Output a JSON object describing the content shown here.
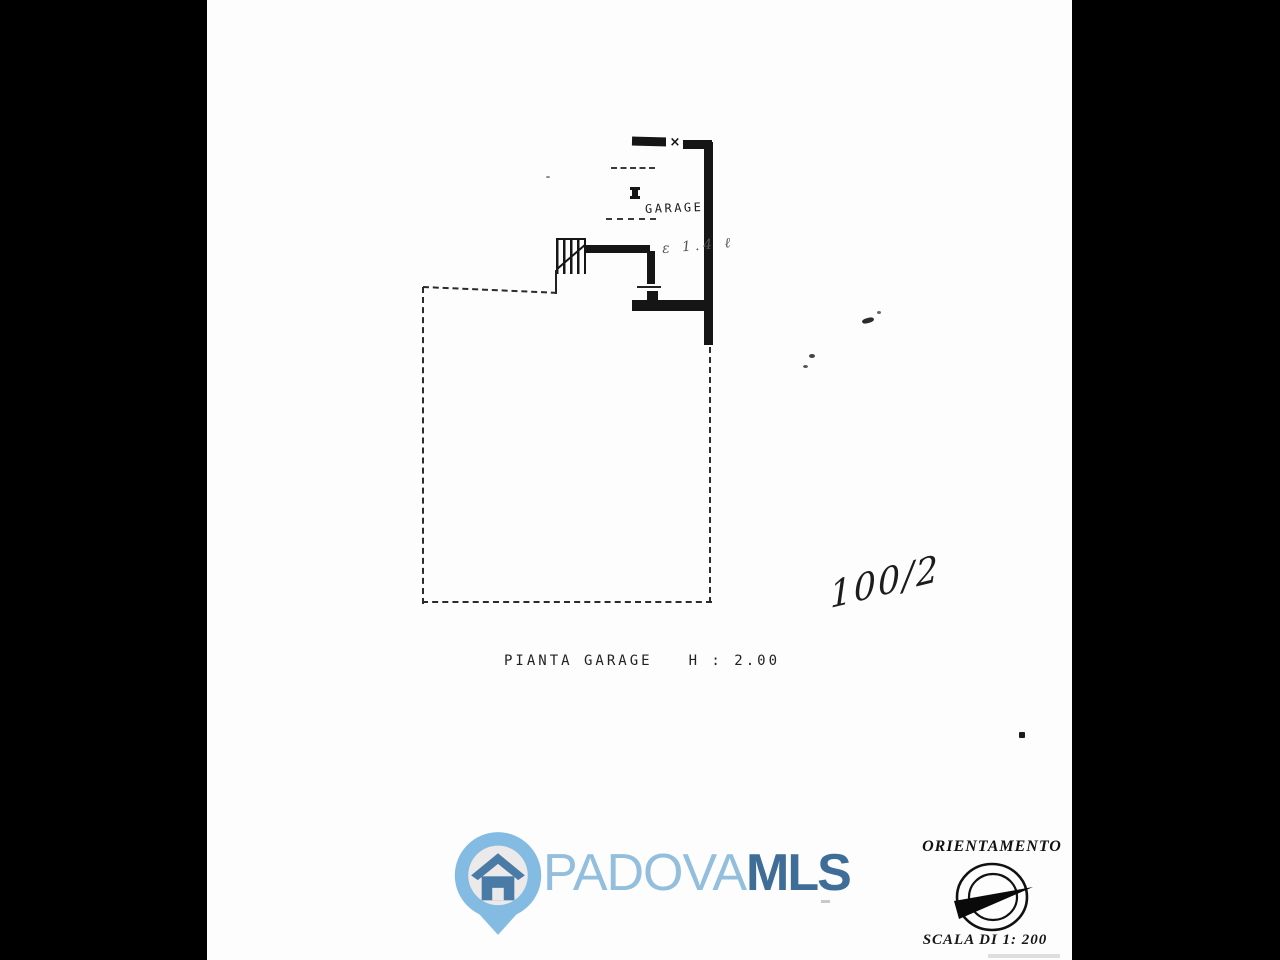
{
  "page": {
    "background": "#fdfdfd",
    "letterbox_color": "#000000"
  },
  "floor_plan": {
    "room_label": "GARAGE",
    "door_marker_glyph": "×",
    "handwritten_note": "ε 1.4 ℓ",
    "caption_title": "PIANTA GARAGE",
    "caption_height": "H : 2.00",
    "handwritten_fraction": "100/2",
    "line_color": "#1a1a1a"
  },
  "branding": {
    "wordmark_primary": "PADOVA",
    "wordmark_secondary": "MLS",
    "colors": {
      "pin": "#84bbe2",
      "pin_inner": "#ebe9e9",
      "house": "#4a7aa6",
      "wordmark_primary": "#93bedd",
      "wordmark_secondary": "#3e6d98"
    }
  },
  "orientation": {
    "title": "ORIENTAMENTO",
    "scale_label": "SCALA DI 1: 200"
  }
}
